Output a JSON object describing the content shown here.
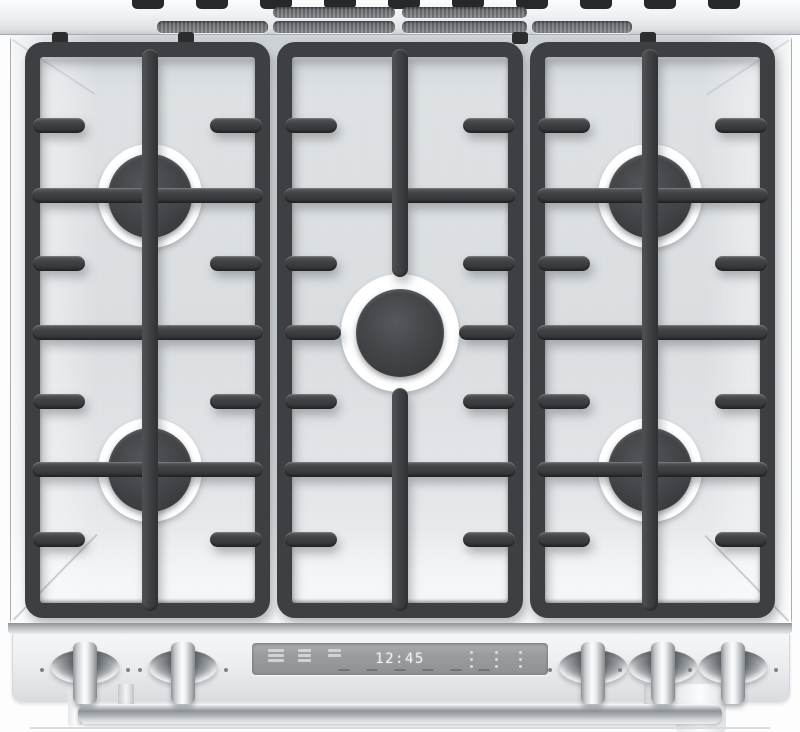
{
  "scene": {
    "title": "Stainless steel slide-in gas range, top view",
    "type": "appliance product photo"
  },
  "vents": {
    "upper_slots": 2,
    "lower_slots": 4
  },
  "cooktop": {
    "grate_sections": 3,
    "burner_count": 5,
    "burners": [
      "left-rear",
      "right-rear",
      "center",
      "left-front",
      "right-front"
    ]
  },
  "control_panel": {
    "knob_count": 5,
    "knobs": [
      "knob-1",
      "knob-2",
      "knob-3",
      "knob-4",
      "knob-5"
    ],
    "display": {
      "clock": "12:45",
      "left_icon_groups": 3,
      "touch_dot_columns": 3
    }
  },
  "colors": {
    "grate": "#3d3f42",
    "stainless": "#dde0e3",
    "display_bg": "#9aa0a4",
    "display_text": "#eef0f1",
    "vent_slot": "#6f7377"
  }
}
